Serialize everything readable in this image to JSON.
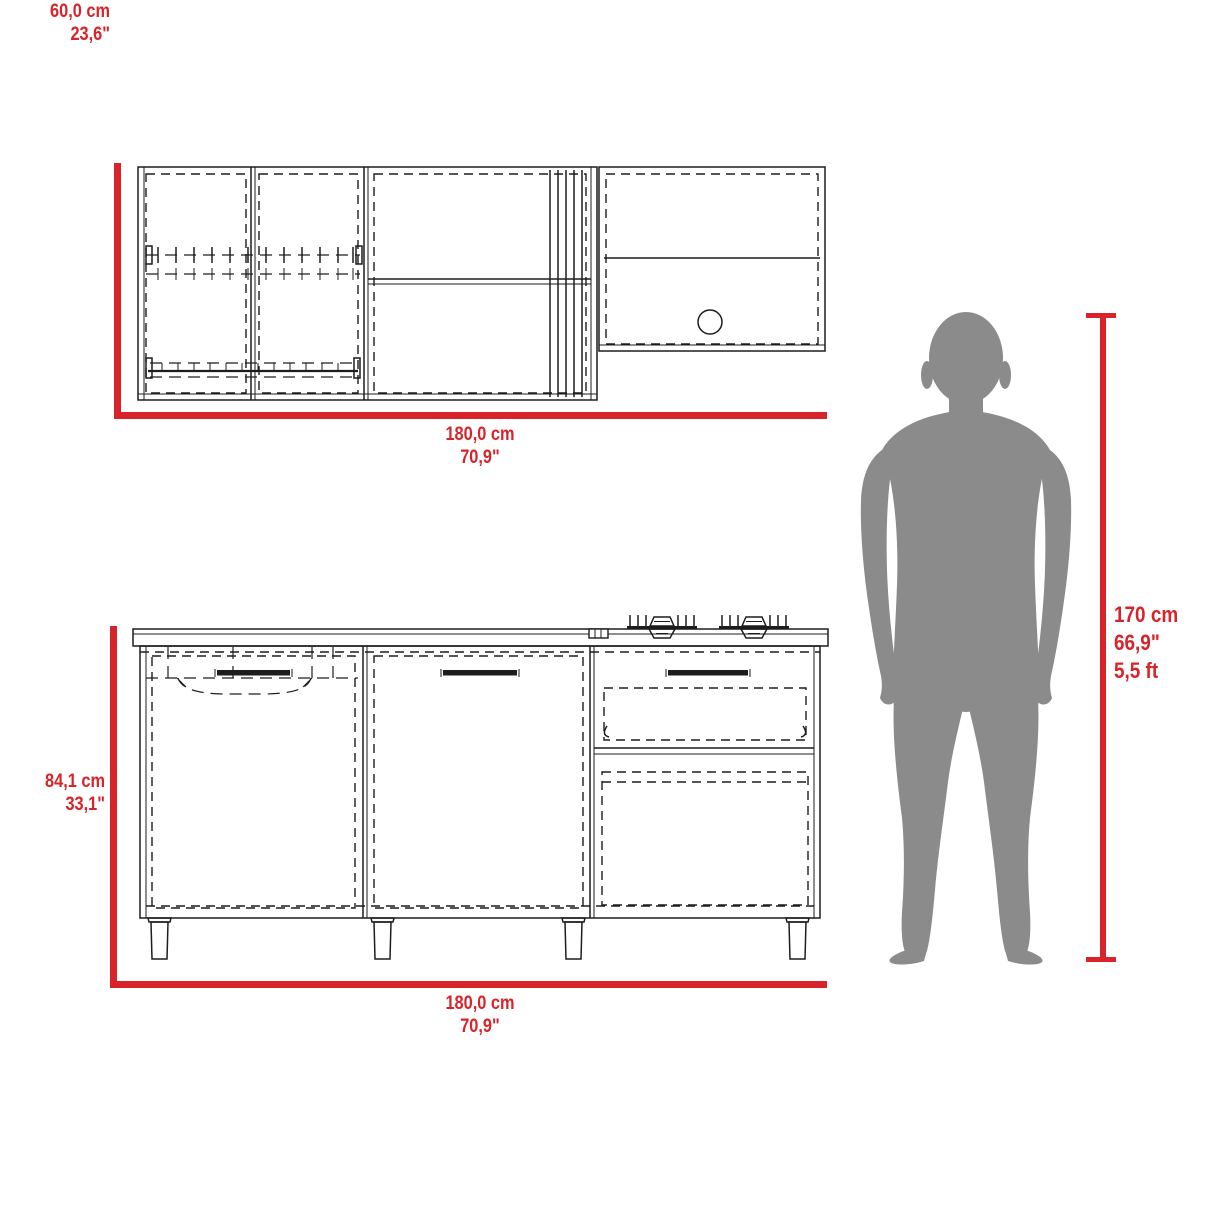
{
  "diagram": {
    "wall_cabinet": {
      "height_cm": "60,0 cm",
      "height_in": "23,6\"",
      "width_cm": "180,0 cm",
      "width_in": "70,9\""
    },
    "base_cabinet": {
      "height_cm": "84,1 cm",
      "height_in": "33,1\"",
      "width_cm": "180,0 cm",
      "width_in": "70,9\""
    },
    "person": {
      "height_cm": "170 cm",
      "height_in": "66,9\"",
      "height_ft": "5,5 ft"
    }
  },
  "colors": {
    "dimension_red": "#d8232a",
    "silhouette_gray": "#8b8b8b",
    "line_black": "#1d1d1d",
    "background": "#ffffff"
  }
}
